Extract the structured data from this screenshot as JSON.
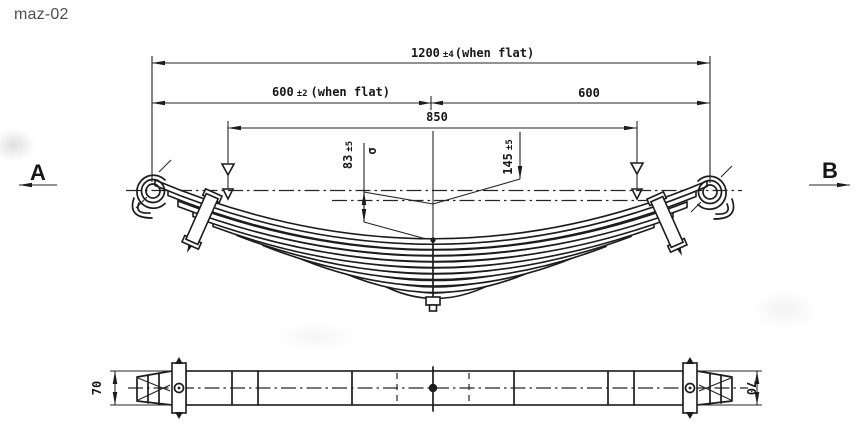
{
  "title": "maz-02",
  "colors": {
    "ink": "#1c1c1c",
    "paper": "#ffffff",
    "title_text": "#4d4d4d"
  },
  "drawing": {
    "dims": {
      "overall": {
        "value": "1200",
        "tol": "±4",
        "note": "(when flat)"
      },
      "left_half": {
        "value": "600",
        "tol": "±2",
        "note": "(when flat)"
      },
      "right_half": {
        "value": "600"
      },
      "load_span": {
        "value": "850"
      },
      "camber_left": {
        "value": "83",
        "tol": "±5"
      },
      "camber_symbol": "σ",
      "camber_right": {
        "value": "145",
        "tol": "±5"
      },
      "width_left": "70",
      "width_right": "70"
    },
    "sections": {
      "left": "A",
      "right": "B"
    }
  }
}
